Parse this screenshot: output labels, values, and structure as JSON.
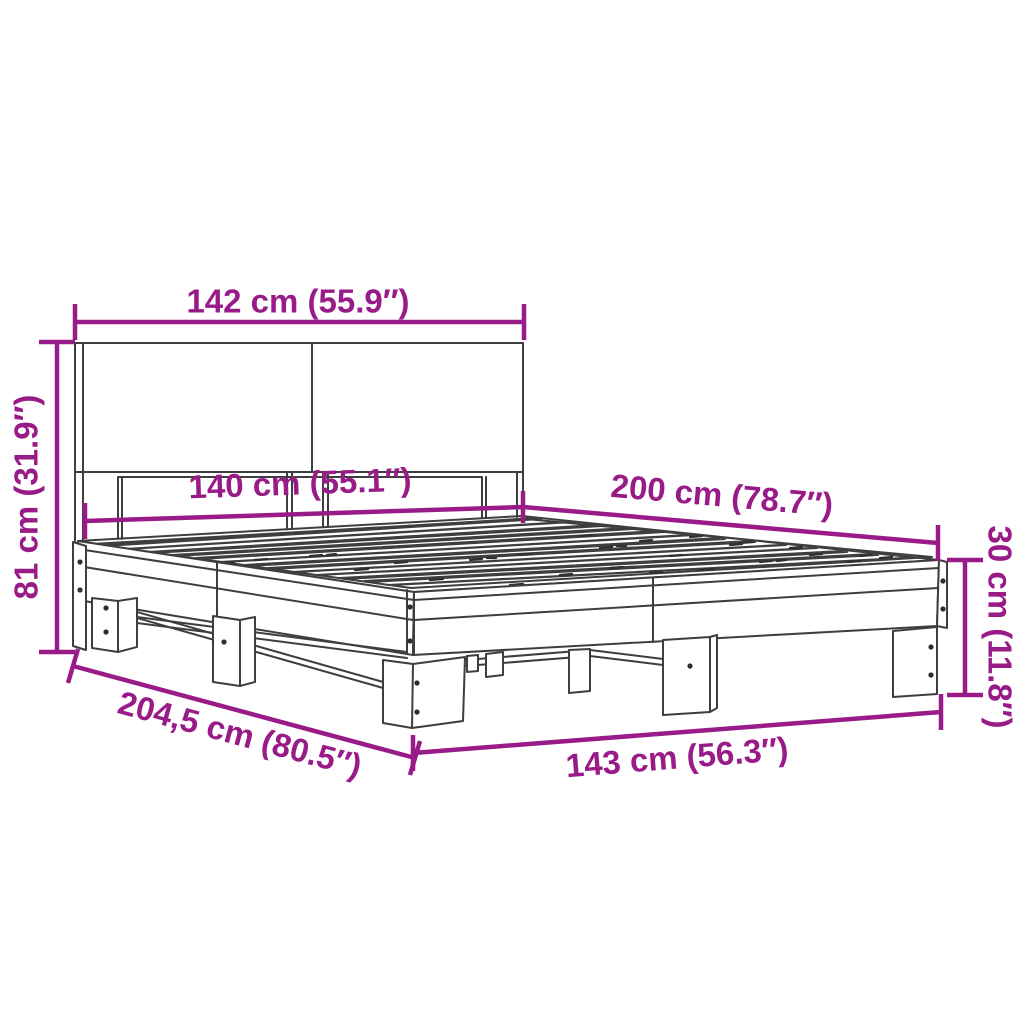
{
  "diagram": {
    "type": "product-dimension-diagram",
    "subject": "bed-frame-with-headboard",
    "colors": {
      "dimension_annotation": "#991B87",
      "line_art": "#3E3E3E",
      "background": "#FFFFFF"
    },
    "dimensions": {
      "headboard_width": "142 cm (55.9″)",
      "headboard_height": "81 cm (31.9″)",
      "slat_width": "140 cm (55.1″)",
      "bed_length": "200 cm (78.7″)",
      "frame_height": "30 cm (11.8″)",
      "total_length": "204,5 cm (80.5″)",
      "total_width": "143 cm (56.3″)"
    }
  }
}
